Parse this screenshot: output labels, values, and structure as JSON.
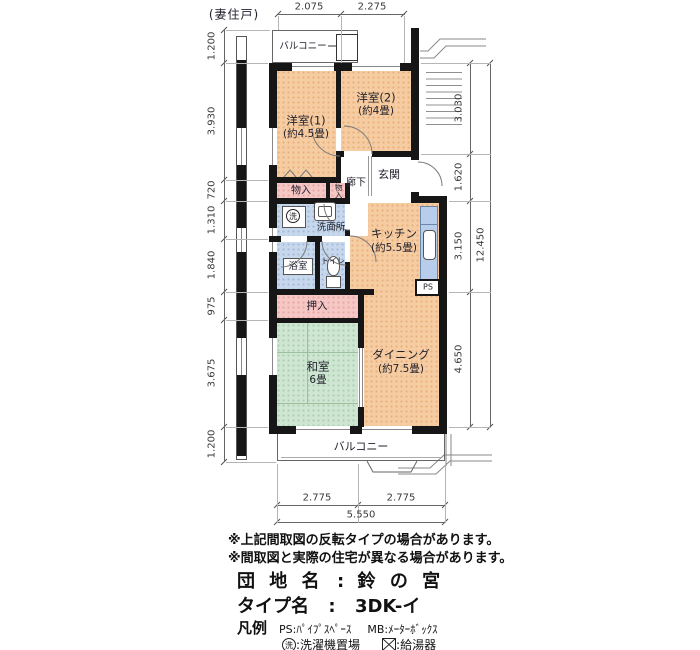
{
  "header": {
    "end_unit": "(妻住戸)"
  },
  "rooms": {
    "yoshitsu1": {
      "name": "洋室(1)",
      "size": "(約4.5畳)"
    },
    "yoshitsu2": {
      "name": "洋室(2)",
      "size": "(約4畳)"
    },
    "kitchen": {
      "name": "キッチン",
      "size": "(約5.5畳)"
    },
    "dining": {
      "name": "ダイニング",
      "size": "(約7.5畳)"
    },
    "washitsu": {
      "name": "和室",
      "size": "6畳"
    },
    "genkan": "玄関",
    "hallway": "廊下",
    "washroom": "洗面所",
    "bath": "浴室",
    "toilet": "トイレ",
    "closet1": "物入",
    "closet2": "物入",
    "oshiire": "押入",
    "balcony_top": "バルコニー",
    "balcony_bottom": "バルコニー",
    "ps": "PS",
    "washer": "洗"
  },
  "dimensions": {
    "top": [
      "2.075",
      "2.275"
    ],
    "left": [
      "1.200",
      "3.930",
      "720",
      "1.310",
      "1.840",
      "975",
      "3.675",
      "1.200"
    ],
    "right": [
      "3.030",
      "1.620",
      "3.150",
      "4.650"
    ],
    "right_total": "12.450",
    "bottom": [
      "2.775",
      "2.775"
    ],
    "bottom_total": "5.550"
  },
  "notes": [
    "※上記間取図の反転タイプの場合があります。",
    "※間取図と実際の住宅が異なる場合があります。"
  ],
  "info": {
    "estate_label": "団 地 名",
    "estate_sep": ":",
    "estate_value": "鈴 の 宮",
    "type_label": "タイプ名",
    "type_sep": ":",
    "type_value": "3DK-イ"
  },
  "legend": {
    "title": "凡例",
    "ps": "PS:ﾊﾟｲﾌﾟｽﾍﾟｰｽ",
    "mb": "MB:ﾒｰﾀｰﾎﾞｯｸｽ",
    "washer_key": "洗",
    "washer_desc": ":洗濯機置場",
    "boiler_desc": ":給湯器"
  },
  "colors": {
    "room": "#f6cda3",
    "closet": "#f5c8c6",
    "wet": "#c7d8ec",
    "tatami": "#cfe7d2",
    "counter": "#b7cde9",
    "wall": "#161616"
  }
}
